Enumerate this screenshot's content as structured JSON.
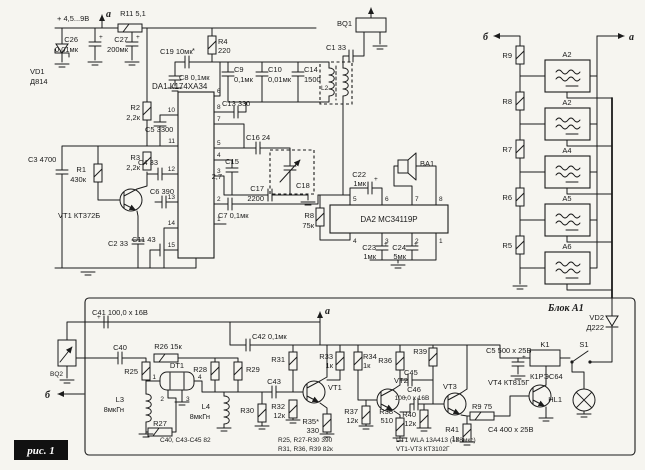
{
  "caption": "рис. 1",
  "colors": {
    "paper": "#f6f5f0",
    "ink": "#1b1b1b"
  },
  "sym": {
    "plus": "+",
    "star": "*"
  },
  "conn": {
    "a": "а",
    "b": "б"
  },
  "power": {
    "supply": "+ 4,5...9В",
    "r11": "R11 5,1",
    "c26": "C26",
    "c26_v": "0,01мк",
    "c27": "C27",
    "c27_v": "200мк",
    "vd1": "VD1",
    "vd1_v": "Д814"
  },
  "amp": {
    "title": "DA1 К174ХА34",
    "pins_left": [
      "10",
      "11",
      "12",
      "13",
      "14",
      "15"
    ],
    "pins_right": [
      "6",
      "8",
      "7",
      "5",
      "4",
      "3",
      "2",
      "1"
    ],
    "r2": "R2",
    "r2_v": "2,2к",
    "c5": "C5 3300",
    "r3": "R3",
    "r3_v": "2,2к",
    "c4": "C4 33",
    "r1": "R1",
    "r1_v": "430к",
    "c3": "C3 4700",
    "vt1": "VT1 КТ372Б",
    "c6": "C6 390",
    "c2": "C2 33",
    "c11": "C11 43",
    "c19": "C19 10мк",
    "c8": "C8 0,1мк",
    "r4": "R4",
    "r4_v": "220",
    "c9": "C9",
    "c9_v": "0,1мк",
    "c10": "C10",
    "c10_v": "0,01мк",
    "c14": "C14",
    "c14_v": "1500",
    "c13": "C13 330",
    "c16": "C16 24",
    "c15": "C15",
    "c15_v": "2,7",
    "c17": "C17",
    "c17_v": "2200",
    "c18": "C18",
    "c7": "C7 0,1мк",
    "l2": "L2",
    "c1": "C1 33",
    "bq1": "BQ1"
  },
  "aud": {
    "da2": "DA2 MC34119P",
    "pins_top": [
      "5",
      "6",
      "7",
      "8"
    ],
    "pins_bottom": [
      "4",
      "3",
      "2",
      "1"
    ],
    "r8": "R8",
    "r8_v": "75к",
    "c22": "C22",
    "c22_v": "1мк",
    "ba1": "BA1",
    "c23": "C23",
    "c23_v": "1мк",
    "c24": "C24",
    "c24_v": "5мк"
  },
  "filt": {
    "r": [
      "R9",
      "R8",
      "R7",
      "R6",
      "R5"
    ],
    "units": [
      "А2",
      "А2",
      "А4",
      "А5",
      "А6"
    ]
  },
  "blk": {
    "title": "Блок А1",
    "c41": "C41 100,0 x 16В",
    "bq2": "BQ2",
    "c40": "C40",
    "r26": "R26 15к",
    "r25": "R25",
    "dt1": "DT1",
    "dt1_pins": [
      "1",
      "2",
      "3",
      "4"
    ],
    "l3": "L3",
    "l3_v": "8мкГн",
    "r27": "R27",
    "r28": "R28",
    "r29": "R29",
    "l4": "L4",
    "l4_v": "8мкГн",
    "c43": "C43",
    "r30": "R30",
    "c42": "C42 0,1мк",
    "r31": "R31",
    "r33": "R33",
    "r33_v": "1к",
    "r34": "R34",
    "r34_v": "1к",
    "vt1": "VT1",
    "r32": "R32",
    "r32_v": "12к",
    "r35": "R35*",
    "r35_v": "330",
    "r36": "R36",
    "vt2": "VT2",
    "c45": "C45",
    "r39": "R39",
    "c46": "C46",
    "c46_v": "100,0 x 16В",
    "r37": "R37",
    "r37_v": "12к",
    "r38": "R38",
    "r38_v": "510",
    "r40": "R40",
    "r40_v": "12к",
    "vt3": "VT3",
    "r9": "R9 75",
    "r41": "R41",
    "r41_v": "1к",
    "vt4": "VT4 КТ815Г",
    "c5": "C5 500 x 25В",
    "k1": "K1",
    "s1": "S1",
    "relay": "К1РЭС64",
    "vd2": "VD2",
    "vd2_v": "Д222",
    "hl1": "HL1",
    "c4": "C4 400 x 25В"
  },
  "notes": [
    "C40, C43-C45 82",
    "R25, R27-R30 390",
    "R31, R36, R39 82к",
    "DT1 WLA 13A413 (128мкс)",
    "VT1-VT3 КТ3102Г"
  ]
}
